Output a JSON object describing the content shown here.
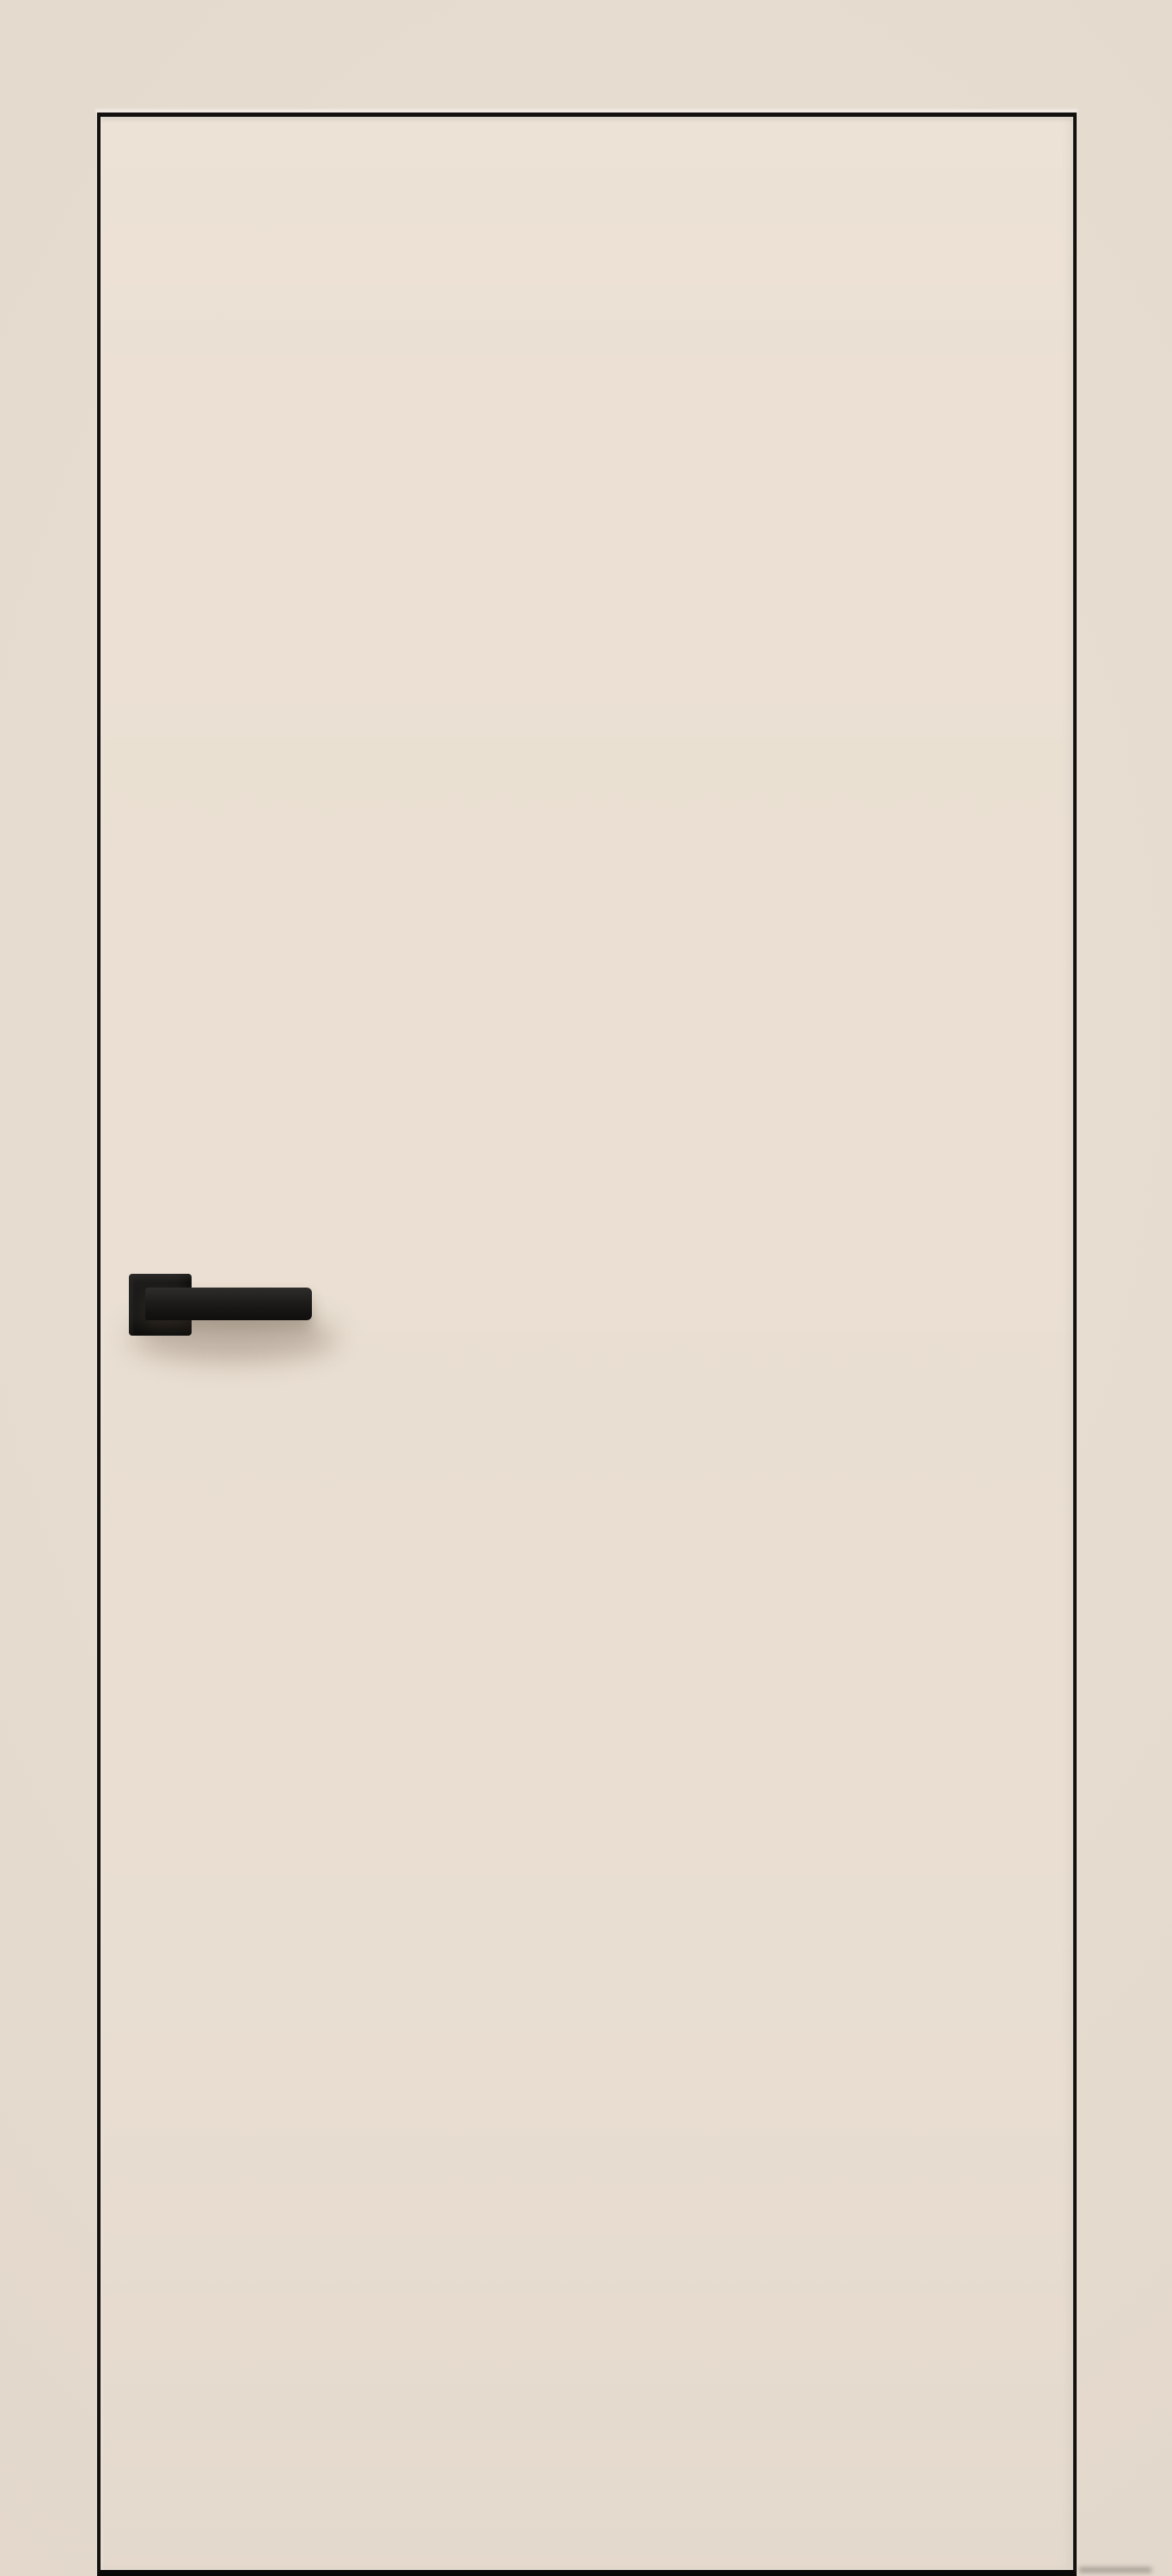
{
  "scene": {
    "type": "product-photo",
    "subject": "Interior flush door in cream finish with black edge trim and a black square-rosette lever handle on the left side, standing on a dark floor gap against a beige wall",
    "door": {
      "style": "flush frameless panel",
      "finish": "cream",
      "trim": "thin black edge outline",
      "handle_side": "left",
      "handle": {
        "type": "lever on square rosette",
        "finish": "matte black",
        "lever_direction": "pointing right"
      },
      "bottom": "black floor gap strip"
    },
    "colors": {
      "wall": "#e8ddd0",
      "door_face": "#ebe0d3",
      "door_edge": "#131110",
      "floor_gap": "#0a0908",
      "handle": "#1d1c1a",
      "handle_highlight": "#2e2d2b",
      "shadow": "rgba(92,74,57,0.32)"
    }
  }
}
